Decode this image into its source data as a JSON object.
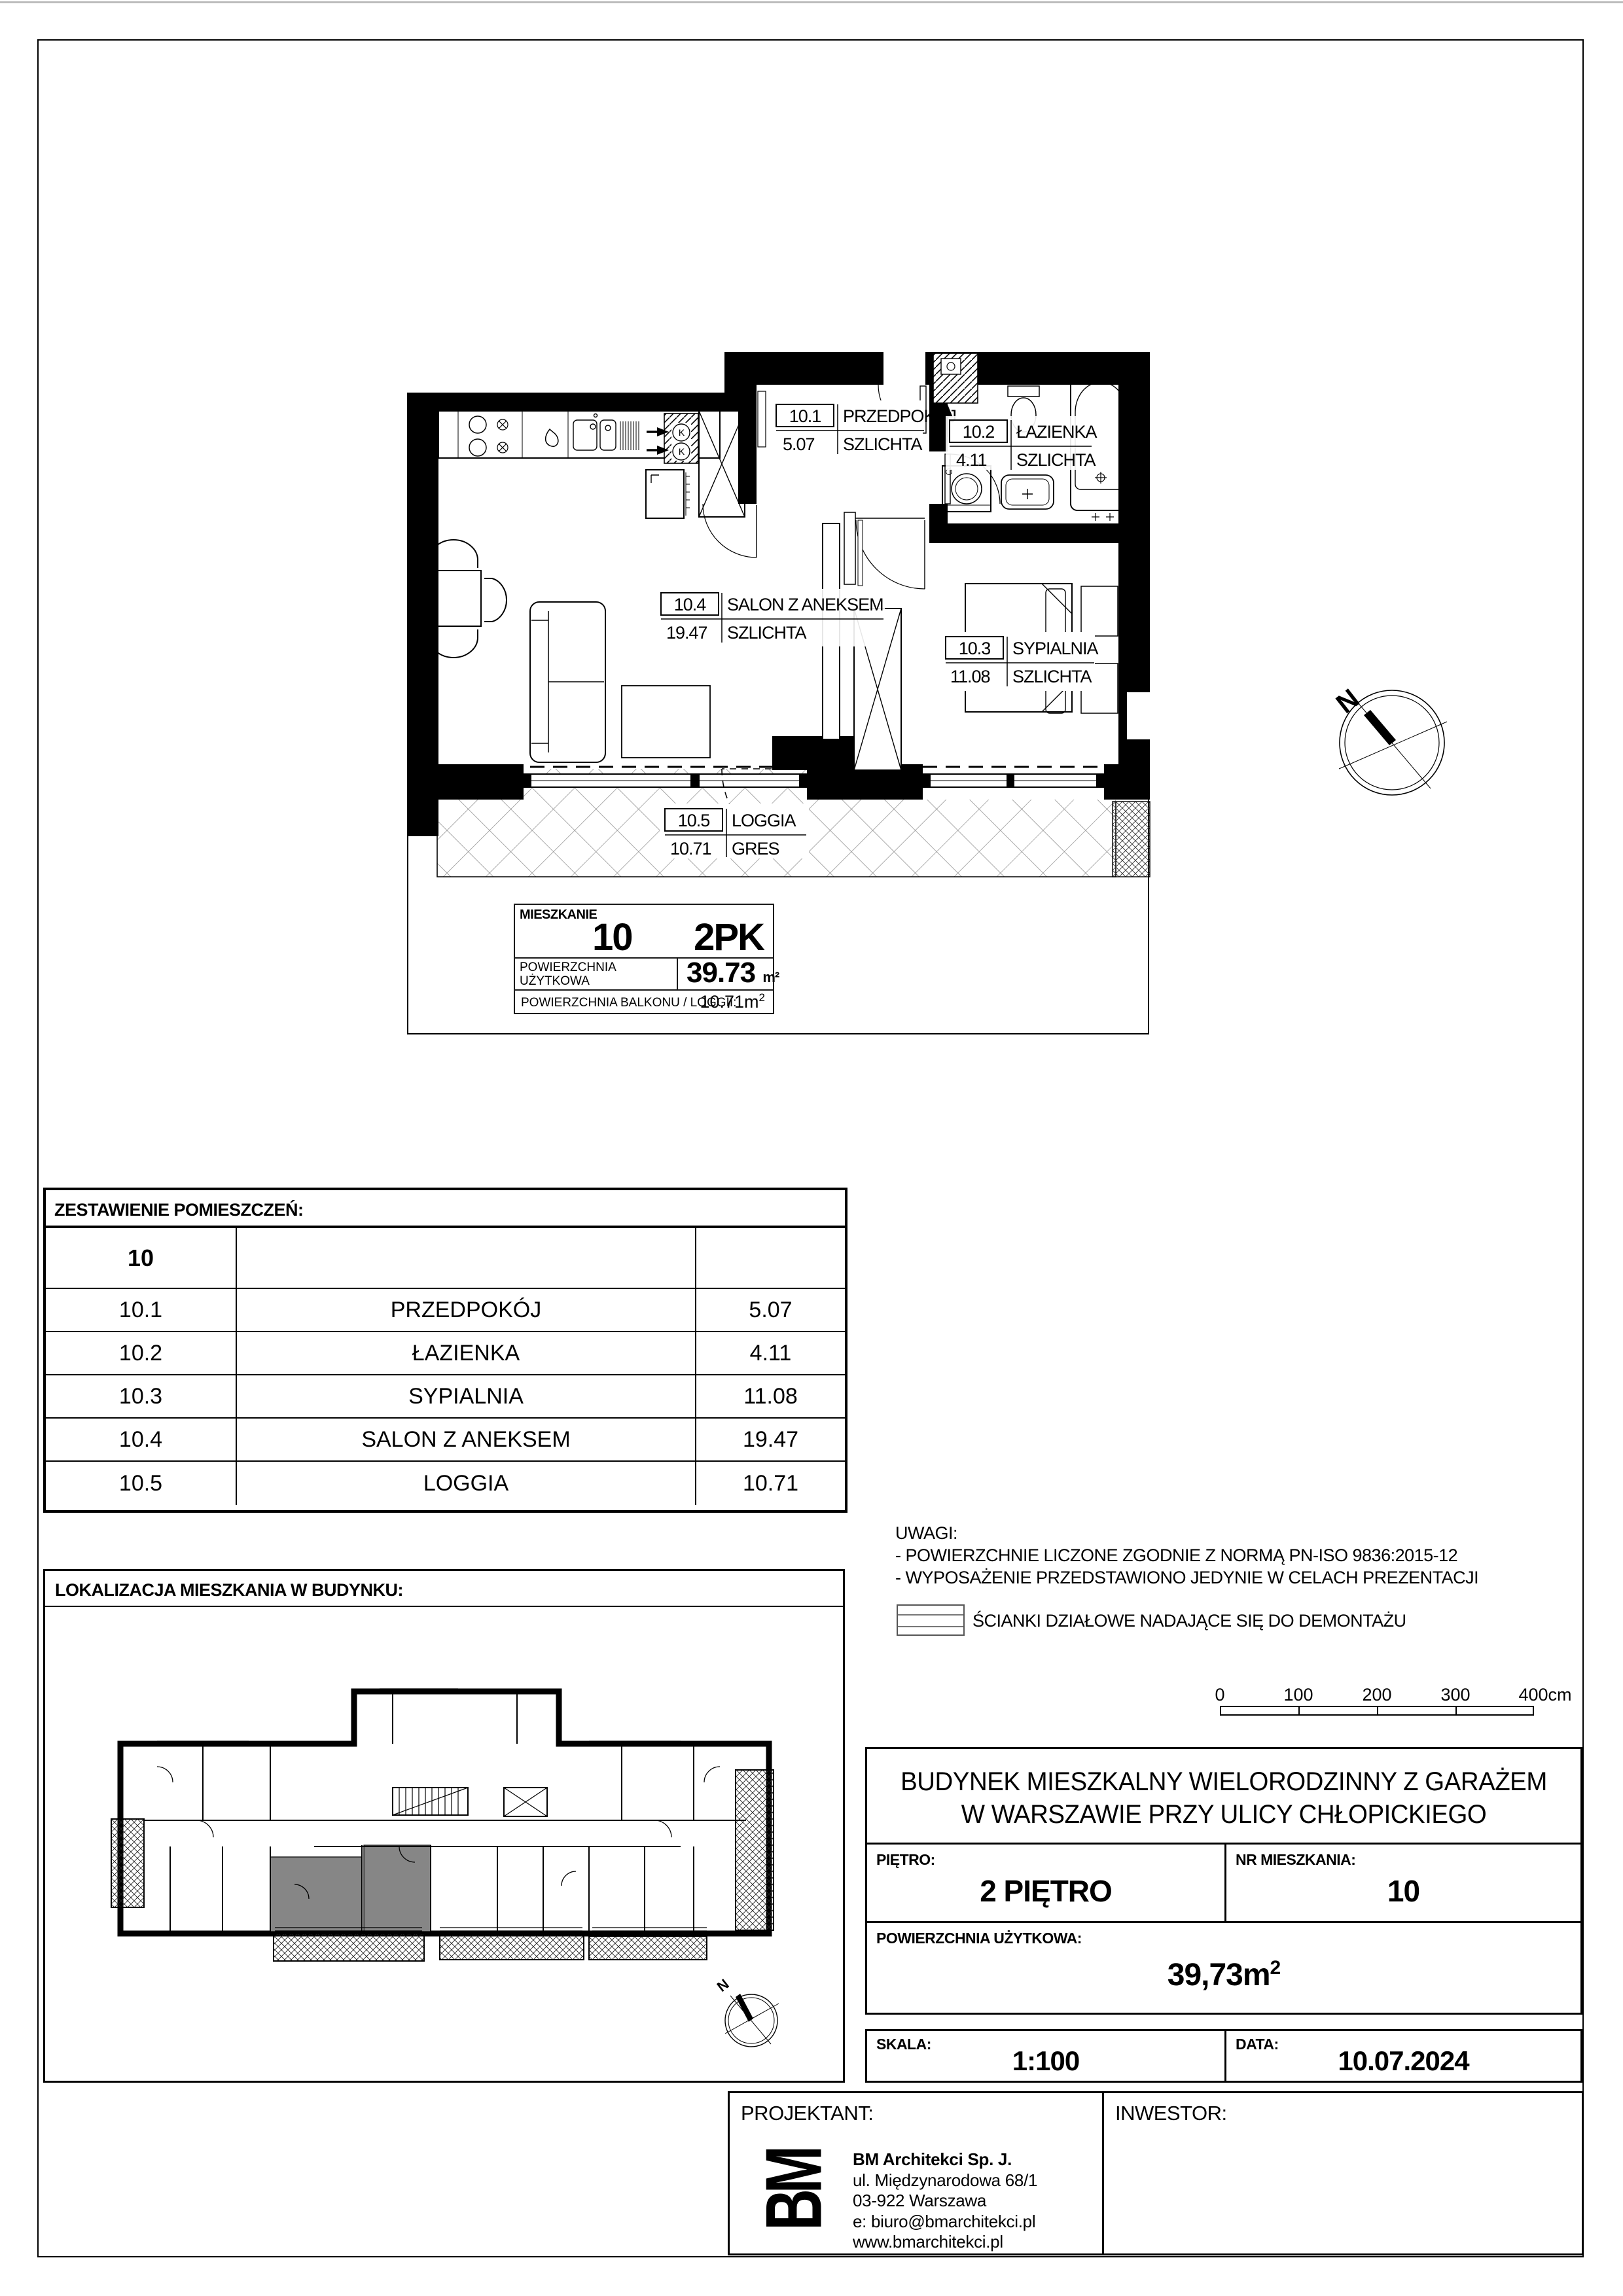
{
  "plan": {
    "north_label": "N",
    "kitchen_vent_label": "K",
    "rooms": [
      {
        "no": "10.1",
        "name": "PRZEDPOKÓJ",
        "finish": "SZLICHTA",
        "area": "5.07"
      },
      {
        "no": "10.2",
        "name": "ŁAZIENKA",
        "finish": "SZLICHTA",
        "area": "4.11"
      },
      {
        "no": "10.3",
        "name": "SYPIALNIA",
        "finish": "SZLICHTA",
        "area": "11.08"
      },
      {
        "no": "10.4",
        "name": "SALON Z ANEKSEM",
        "finish": "SZLICHTA",
        "area": "19.47"
      },
      {
        "no": "10.5",
        "name": "LOGGIA",
        "finish": "GRES",
        "area": "10.71"
      }
    ]
  },
  "info_box": {
    "title": "MIESZKANIE",
    "number": "10",
    "type": "2PK",
    "area_label_1": "POWIERZCHNIA",
    "area_label_2": "UŻYTKOWA",
    "area_value": "39.73",
    "area_unit": "m²",
    "balcony_label": "POWIERZCHNIA BALKONU / LOGGII:",
    "balcony_value": "10.71m",
    "balcony_sup": "2"
  },
  "room_table": {
    "header": "ZESTAWIENIE POMIESZCZEŃ:",
    "apartment_no": "10",
    "rows": [
      {
        "no": "10.1",
        "name": "PRZEDPOKÓJ",
        "area": "5.07"
      },
      {
        "no": "10.2",
        "name": "ŁAZIENKA",
        "area": "4.11"
      },
      {
        "no": "10.3",
        "name": "SYPIALNIA",
        "area": "11.08"
      },
      {
        "no": "10.4",
        "name": "SALON Z ANEKSEM",
        "area": "19.47"
      },
      {
        "no": "10.5",
        "name": "LOGGIA",
        "area": "10.71"
      }
    ]
  },
  "location": {
    "header": "LOKALIZACJA MIESZKANIA W BUDYNKU:",
    "north_label": "N",
    "highlight_color": "#868686"
  },
  "notes": {
    "title": "UWAGI:",
    "lines": [
      "- POWIERZCHNIE LICZONE ZGODNIE Z NORMĄ PN-ISO 9836:2015-12",
      "- WYPOSAŻENIE PRZEDSTAWIONO JEDYNIE W CELACH PREZENTACJI"
    ],
    "legend": "ŚCIANKI DZIAŁOWE NADAJĄCE SIĘ DO DEMONTAŻU"
  },
  "scalebar": {
    "labels": [
      "0",
      "100",
      "200",
      "300",
      "400cm"
    ]
  },
  "title_block": {
    "project_line1": "BUDYNEK MIESZKALNY WIELORODZINNY Z GARAŻEM",
    "project_line2": "W WARSZAWIE PRZY ULICY CHŁOPICKIEGO",
    "floor_label": "PIĘTRO:",
    "floor_value": "2 PIĘTRO",
    "apt_label": "NR MIESZKANIA:",
    "apt_value": "10",
    "area_label": "POWIERZCHNIA UŻYTKOWA:",
    "area_value": "39,73m",
    "area_sup": "2",
    "scale_label": "SKALA:",
    "scale_value": "1:100",
    "date_label": "DATA:",
    "date_value": "10.07.2024"
  },
  "footer": {
    "designer_label": "PROJEKTANT:",
    "investor_label": "INWESTOR:",
    "logo_text": "BM",
    "company": "BM Architekci  Sp. J.",
    "address": [
      "ul. Międzynarodowa 68/1",
      "03-922 Warszawa",
      "e: biuro@bmarchitekci.pl",
      "www.bmarchitekci.pl"
    ]
  }
}
